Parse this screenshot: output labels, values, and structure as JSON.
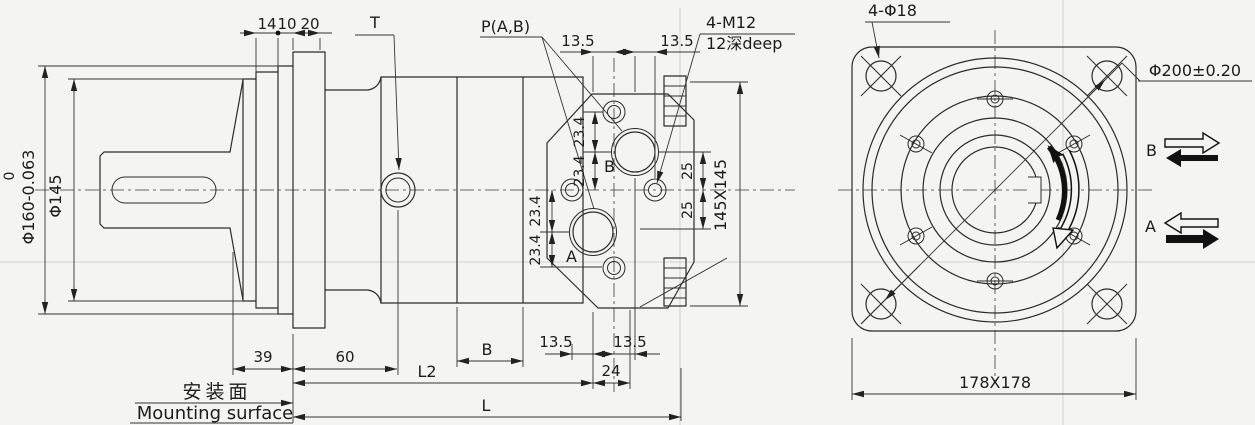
{
  "side_view": {
    "top_dims": {
      "d14": "14",
      "d10": "10",
      "d20": "20"
    },
    "labels": {
      "t": "T",
      "p": "P(A,B)",
      "m12": "4-M12",
      "m12_depth": "12深deep",
      "port_a": "A",
      "port_b": "B"
    },
    "dia": {
      "upper": "0",
      "d160": "Φ160-0.063",
      "d145": "Φ145"
    },
    "port_dims": {
      "top_left": "13.5",
      "top_right": "13.5",
      "bottom_left": "13.5",
      "bottom_right": "13.5",
      "spacing": "24"
    },
    "face_dims": {
      "b_up": "23.4",
      "b_dn": "23.4",
      "a_up": "23.4",
      "a_dn": "23.4",
      "r_up": "25",
      "r_dn": "25",
      "square": "145X145"
    },
    "bottom_dims": {
      "d39": "39",
      "d60": "60",
      "b": "B",
      "l2": "L2",
      "l": "L"
    },
    "mounting": {
      "cn": "安装面",
      "en": "Mounting surface"
    }
  },
  "front_view": {
    "labels": {
      "holes": "4-Φ18",
      "bolt_circle": "Φ200±0.20",
      "square": "178X178",
      "b": "B",
      "a": "A"
    }
  }
}
